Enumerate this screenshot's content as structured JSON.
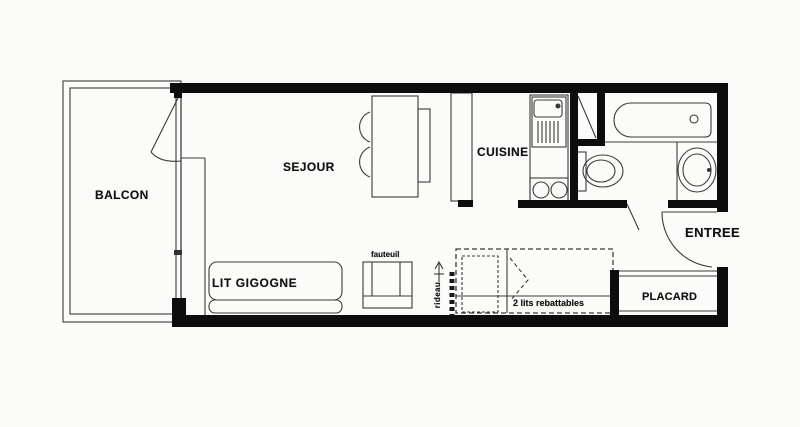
{
  "title": "Plan d'appartement studio",
  "rooms": {
    "balcon": "BALCON",
    "sejour": "SEJOUR",
    "cuisine": "CUISINE",
    "entree": "ENTREE",
    "placard": "PLACARD"
  },
  "furniture": {
    "lit_gigogne": "LIT GIGOGNE",
    "fauteuil": "fauteuil",
    "lits_rebattables": "2 lits rebattables",
    "rideau": "rideau"
  },
  "colors": {
    "wall": "#0d0d0d",
    "line": "#3b3b3b",
    "background": "#fbfbfa",
    "text": "#111111"
  }
}
